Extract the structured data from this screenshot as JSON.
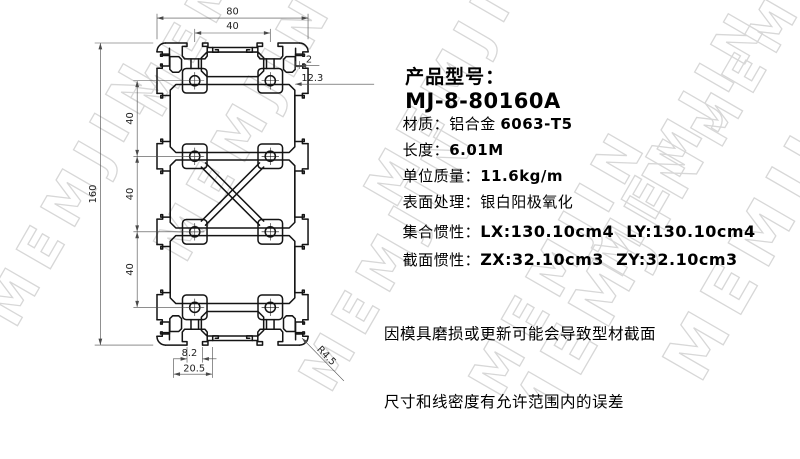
{
  "watermark": {
    "text": "MEMJIN"
  },
  "title": {
    "label": "产品型号：",
    "model": "MJ-8-80160A"
  },
  "specs": [
    {
      "label": "材质：",
      "value_regular": "铝合金 ",
      "value_bold": "6063-T5"
    },
    {
      "label": "长度：",
      "value_regular": "",
      "value_bold": "6.01M"
    },
    {
      "label": "单位质量：",
      "value_regular": "",
      "value_bold": "11.6kg/m"
    },
    {
      "label": "表面处理：",
      "value_regular": "银白阳极氧化",
      "value_bold": ""
    }
  ],
  "inertia": [
    {
      "label": "集合惯性：",
      "value": "LX:130.10cm4  LY:130.10cm4"
    },
    {
      "label": "截面惯性：",
      "value": "ZX:32.10cm3  ZY:32.10cm3"
    }
  ],
  "notes": {
    "line1": "因模具磨损或更新可能会导致型材截面",
    "line2": "尺寸和线密度有允许范围内的误差"
  },
  "drawing": {
    "dims": {
      "overall_width": "80",
      "slot_pitch": "40",
      "top_wall": "2",
      "side_depth": "12.3",
      "overall_height": "160",
      "module_1": "40",
      "module_2": "40",
      "module_3": "40",
      "slot_opening": "8.2",
      "edge_offset": "20.5",
      "corner_radius": "R4.5"
    }
  },
  "colors": {
    "profile_line": "#141414",
    "dim_line": "#4a4a4a",
    "watermark_outline": "#d7d7d7"
  }
}
